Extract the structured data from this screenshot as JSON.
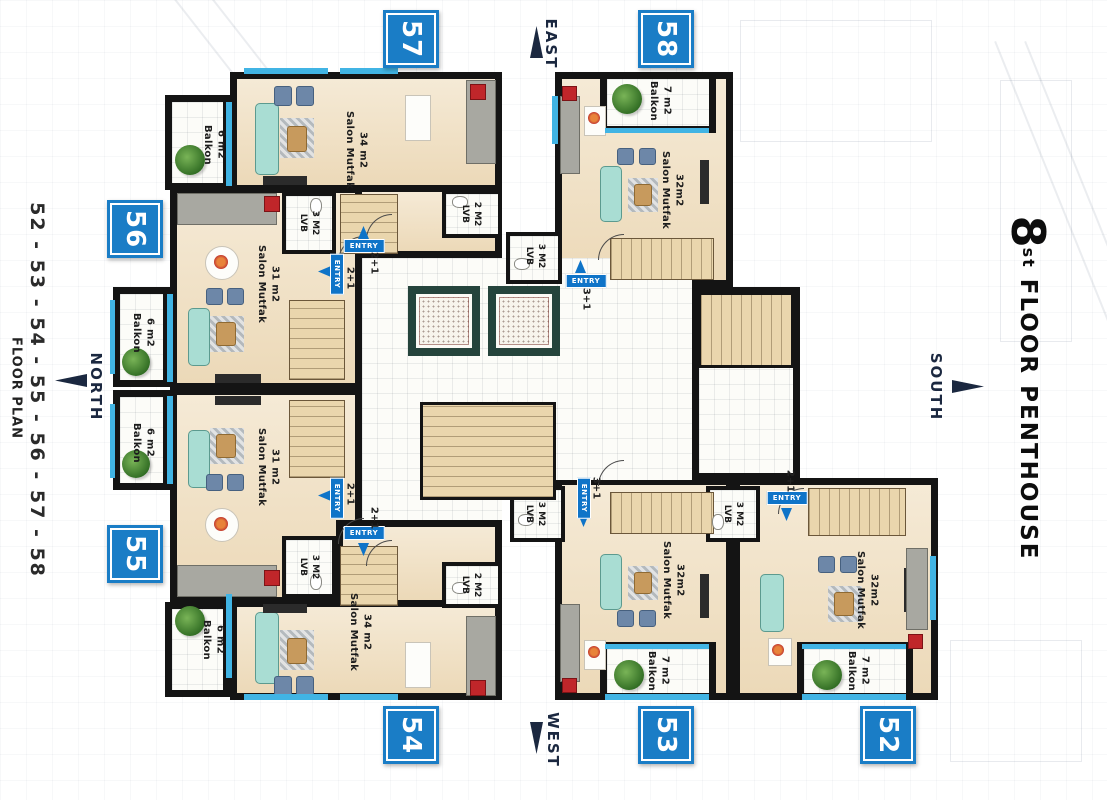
{
  "title_right": {
    "floor_number": "8",
    "floor_suffix": "st",
    "floor_text": " FLOOR PENTHOUSE"
  },
  "title_left": {
    "units_range": "52 - 53 - 54 - 55 - 56 - 57 - 58",
    "plan_label": "FLOOR PLAN"
  },
  "compass": {
    "north": "NORTH",
    "south": "SOUTH",
    "east": "EAST",
    "west": "WEST"
  },
  "labels": {
    "entry": "ENTRY"
  },
  "colors": {
    "badge_blue": "#1a7dc6",
    "entry_blue": "#0f74c8",
    "window_cyan": "#41b4e4",
    "wall_black": "#141414",
    "compass_navy": "#1b2840"
  },
  "units": [
    {
      "number": "52",
      "salon_name": "Salon Mutfak",
      "salon_area": "32m2",
      "balcony_name": "Balkon",
      "balcony_area": "7 m2",
      "bath_name": "LVB",
      "bath_area": "3 M2",
      "plan_type": "2+1"
    },
    {
      "number": "53",
      "salon_name": "Salon Mutfak",
      "salon_area": "32m2",
      "balcony_name": "Balkon",
      "balcony_area": "7 m2",
      "bath_name": "LVB",
      "bath_area": "3 M2",
      "plan_type": "3+1"
    },
    {
      "number": "54",
      "salon_name": "Salon Mutfak",
      "salon_area": "34 m2",
      "balcony_name": "Balkon",
      "balcony_area": "6 m2",
      "bath_name": "LVB",
      "bath_area": "2 M2",
      "plan_type": "2+1"
    },
    {
      "number": "55",
      "salon_name": "Salon Mutfak",
      "salon_area": "31 m2",
      "balcony_name": "Balkon",
      "balcony_area": "6 m2",
      "bath_name": "LVB",
      "bath_area": "3 M2",
      "plan_type": "2+1"
    },
    {
      "number": "56",
      "salon_name": "Salon Mutfak",
      "salon_area": "31 m2",
      "balcony_name": "Balkon",
      "balcony_area": "6 m2",
      "bath_name": "LVB",
      "bath_area": "3 M2",
      "plan_type": "2+1"
    },
    {
      "number": "57",
      "salon_name": "Salon Mutfak",
      "salon_area": "34 m2",
      "balcony_name": "Balkon",
      "balcony_area": "6 m2",
      "bath_name": "LVB",
      "bath_area": "2 M2",
      "plan_type": "2+1"
    },
    {
      "number": "58",
      "salon_name": "Salon Mutfak",
      "salon_area": "32m2",
      "balcony_name": "Balkon",
      "balcony_area": "7 m2",
      "bath_name": "LVB",
      "bath_area": "3 M2",
      "plan_type": "3+1"
    }
  ]
}
